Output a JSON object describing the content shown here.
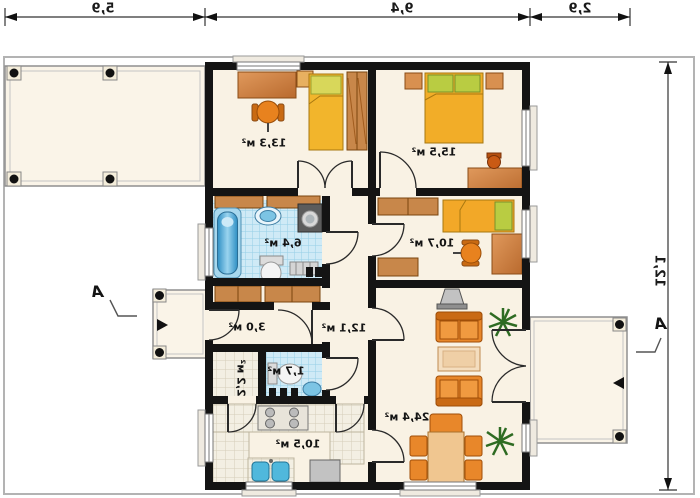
{
  "plan": {
    "dimensions": {
      "top": [
        "5,9",
        "9,4",
        "2,9"
      ],
      "right": "12,1"
    },
    "section_markers": {
      "left": "A",
      "right": "A"
    },
    "rooms": {
      "room1": "13,3 м²",
      "room2": "15,5 м²",
      "bathroom": "6,4 м²",
      "room3": "10,7 м²",
      "hall": "12,1 м²",
      "vestibule": "3,0 м²",
      "wc": "1,7 м²",
      "pantry": "2,2 м²",
      "kitchen": "10,5 м²",
      "living": "24,4 м²"
    },
    "colors": {
      "wall": "#141414",
      "floor": "#f9f2e4",
      "tile_blue": "#cfeaf6",
      "tile_white": "#f3efe3",
      "furniture_orange": "#e8872a",
      "wood": "#c8874a",
      "bed_yellow": "#f2b52c",
      "pillow_green": "#b9cc42",
      "water_blue": "#4ab0d8",
      "plant_green": "#2e6b22",
      "appliance_gray": "#bdbdbd"
    }
  }
}
